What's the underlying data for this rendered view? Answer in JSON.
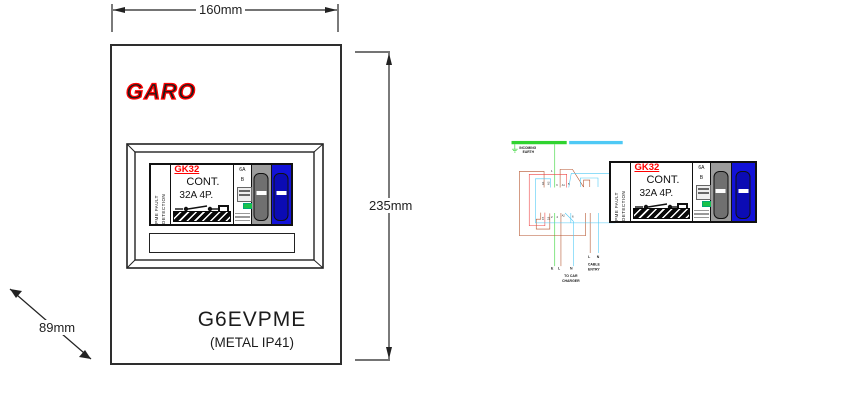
{
  "left_panel": {
    "dim_width": "160mm",
    "dim_height": "235mm",
    "dim_depth": "89mm",
    "brand": "GARO",
    "model": "G6EVPME",
    "spec": "(METAL IP41)"
  },
  "device": {
    "pme_line1": "PME FAULT",
    "pme_line2": "DETECTION",
    "model": "GK32",
    "cont_label": "CONT.",
    "rating": "32A 4P.",
    "mcb_rating": "6A",
    "mcb_curve": "B"
  },
  "wiring": {
    "incoming_earth_line1": "INCOMING",
    "incoming_earth_line2": "EARTH",
    "terminals_top": [
      "A1",
      "A2",
      "1",
      "3",
      "A1",
      "5"
    ],
    "terminals_bottom": [
      "15",
      "18",
      "2",
      "4",
      "A2",
      "6"
    ],
    "out_e": "E",
    "out_l": "L",
    "out_n": "N",
    "to_car_line1": "TO CAR",
    "to_car_line2": "CHARGER",
    "cable_l": "L",
    "cable_n": "N",
    "cable_entry_line1": "CABLE",
    "cable_entry_line2": "ENTRY",
    "colors": {
      "earth_green": "#2fd32f",
      "neutral_cyan": "#4ec9f5",
      "live_brown": "#b5532c",
      "aux_red": "#ee4545",
      "brand_red": "#ff0000",
      "breaker_blue": "#1212d8"
    }
  }
}
